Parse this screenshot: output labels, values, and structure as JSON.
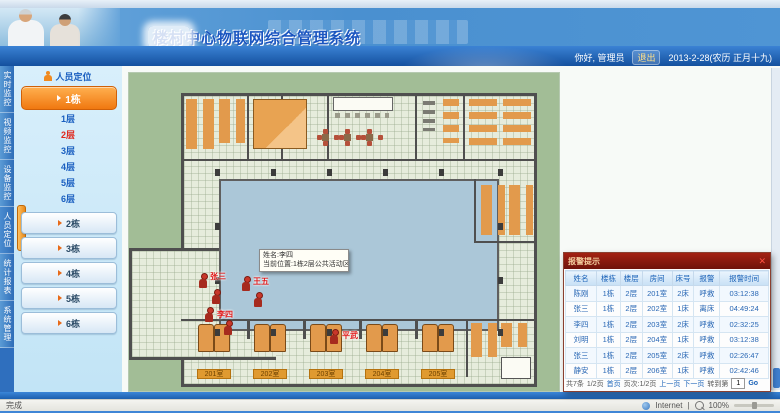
{
  "header": {
    "title": "楼村中心物联网综合管理系统",
    "greeting": "你好, 管理员",
    "logout": "退出",
    "date": "2013-2-28(农历 正月十九)"
  },
  "nav_tabs": [
    {
      "label": "实时监控"
    },
    {
      "label": "视频监控"
    },
    {
      "label": "设备监控"
    },
    {
      "label": "人员定位"
    },
    {
      "label": "统计报表"
    },
    {
      "label": "系统管理"
    }
  ],
  "sidebar": {
    "header": "人员定位",
    "building_active": "1栋",
    "floors": [
      {
        "label": "1层"
      },
      {
        "label": "2层"
      },
      {
        "label": "3层"
      },
      {
        "label": "4层"
      },
      {
        "label": "5层"
      },
      {
        "label": "6层"
      }
    ],
    "other_buildings": [
      "2栋",
      "3栋",
      "4栋",
      "5栋",
      "6栋"
    ]
  },
  "map": {
    "tooltip": {
      "line1": "姓名:李四",
      "line2": "当前位置:1栋2层公共活动区"
    },
    "markers": [
      {
        "name": "张三"
      },
      {
        "name": "王五"
      },
      {
        "name": "李四"
      },
      {
        "name": "平武"
      }
    ],
    "room_labels": [
      "201室",
      "202室",
      "203室",
      "204室",
      "205室"
    ]
  },
  "alarm_popup": {
    "title": "报警提示",
    "close": "✕",
    "columns": [
      "姓名",
      "楼栋",
      "楼层",
      "房间",
      "床号",
      "报警",
      "报警时间"
    ],
    "rows": [
      [
        "陈刚",
        "1栋",
        "2层",
        "201室",
        "2床",
        "呼救",
        "03:12:38"
      ],
      [
        "张三",
        "1栋",
        "2层",
        "202室",
        "1床",
        "离床",
        "04:49:24"
      ],
      [
        "李四",
        "1栋",
        "2层",
        "203室",
        "2床",
        "呼救",
        "02:32:25"
      ],
      [
        "刘明",
        "1栋",
        "2层",
        "204室",
        "1床",
        "呼救",
        "03:12:38"
      ],
      [
        "张三",
        "1栋",
        "2层",
        "205室",
        "2床",
        "呼救",
        "02:26:47"
      ],
      [
        "静安",
        "1栋",
        "2层",
        "206室",
        "1床",
        "呼救",
        "02:42:46"
      ]
    ],
    "pagination": {
      "total": "共7条",
      "page": "1/2页",
      "first": "首页",
      "info": "页次:1/2页",
      "prev": "上一页",
      "next": "下一页",
      "goto": "转到第",
      "input": "1",
      "go": "Go"
    }
  },
  "statusbar": {
    "left": "完成",
    "network": "Internet",
    "zoom_level": "100%"
  }
}
